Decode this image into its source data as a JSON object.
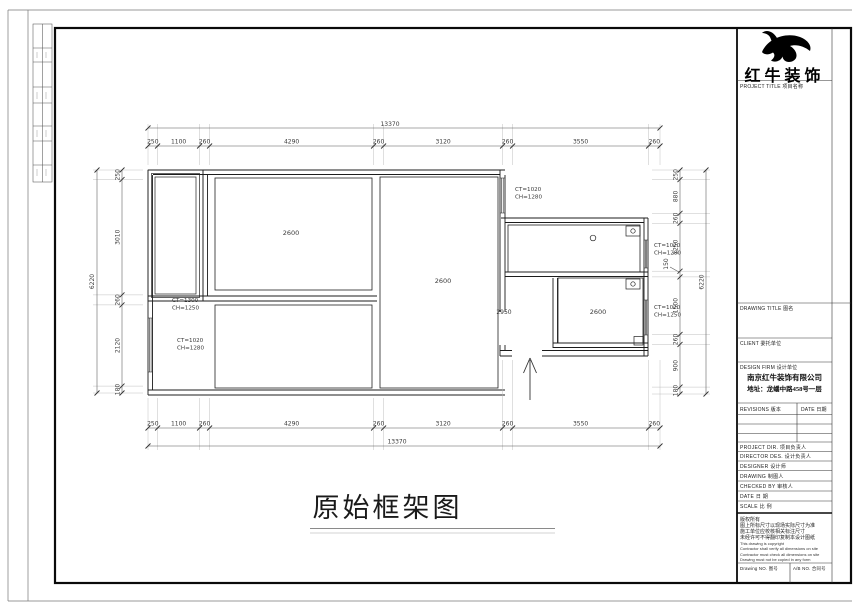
{
  "sheet": {
    "drawing_title": "原始框架图"
  },
  "title_block": {
    "brand": "红牛装饰",
    "project_title_label": "PROJECT TITLE 项目名称",
    "drawing_title_label": "DRAWING TITLE 图名",
    "client_label": "CLIENT 委托单位",
    "design_firm_label": "DESIGN FIRM 设计单位",
    "firm_name": "南京红牛装饰有限公司",
    "firm_address": "地址：龙蟠中路458号一层",
    "revisions_label": "REVISIONS 版本",
    "revision_date_label": "DATE 日期",
    "rows": [
      "PROJECT DIR. 项目负责人",
      "DIRECTOR DES. 设计负责人",
      "DESIGNER 设计师",
      "DRAWING 制图人",
      "CHECKED BY 审核人",
      "DATE 日 期",
      "SCALE 比 例"
    ],
    "notes": [
      "版权所有",
      "图上所标尺寸以现场实际尺寸为准",
      "施工单位应校核相关标注尺寸",
      "未经许可不得翻印复制本设计图纸",
      "This drawing is copyright",
      "Contractor shall verify all dimensions on site",
      "Contractor must check all dimensions on site",
      "Drawing must not be copied in any form"
    ],
    "drawing_no_label": "Drawing NO. 图号",
    "contract_no_label": "A/B NO. 合同号"
  },
  "plan": {
    "room_labels": [
      "2600",
      "2600",
      "2600"
    ],
    "hall_dim": "2950",
    "window_tags": [
      [
        "CT=1300",
        "CH=1250"
      ],
      [
        "CT=1020",
        "CH=1280"
      ],
      [
        "CT=1020",
        "CH=1280"
      ],
      [
        "CT=1020",
        "CH=1280"
      ],
      [
        "CT=1020",
        "CH=1250"
      ]
    ],
    "dims": {
      "top": [
        "250",
        "1100",
        "260",
        "4290",
        "260",
        "3120",
        "260",
        "3550",
        "260"
      ],
      "top_total": "13370",
      "bottom": [
        "250",
        "1100",
        "260",
        "4290",
        "260",
        "3120",
        "260",
        "3550",
        "260"
      ],
      "bottom_total": "13370",
      "left": [
        "250",
        "3010",
        "260",
        "2120",
        "180"
      ],
      "left_total": "6220",
      "right": [
        "250",
        "880",
        "260",
        "1250",
        "150",
        "1500",
        "260",
        "900",
        "180"
      ],
      "right_total": "6220"
    }
  }
}
